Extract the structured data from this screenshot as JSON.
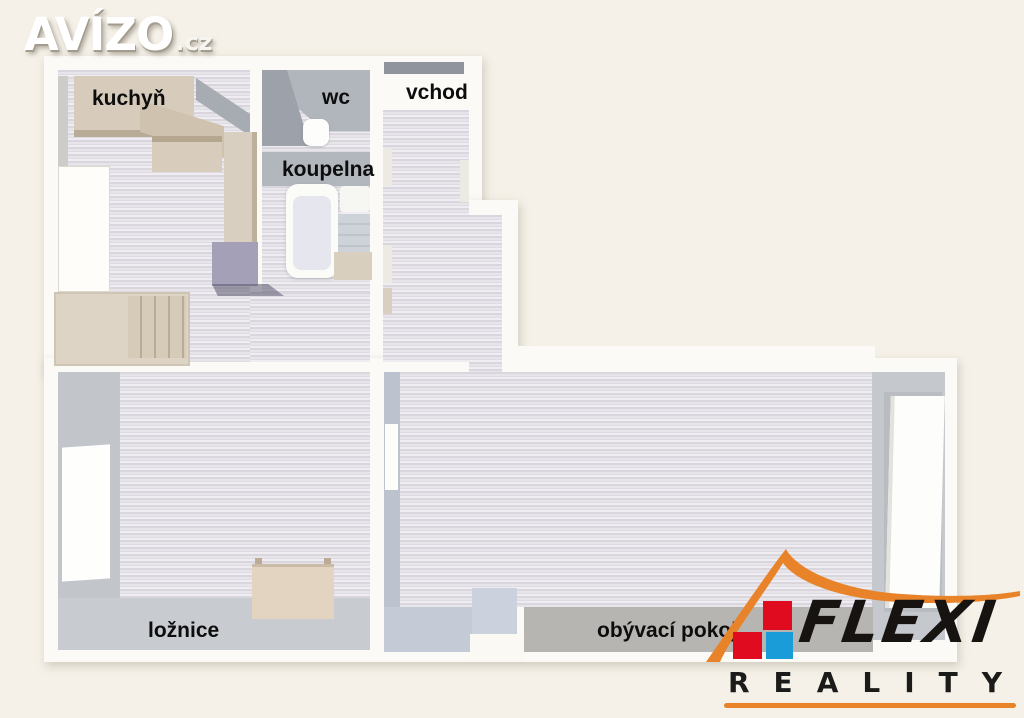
{
  "watermark": {
    "brand": "AVÍZO",
    "tld": ".cz"
  },
  "floorplan": {
    "rooms": [
      {
        "id": "kuchyn",
        "label": "kuchyň"
      },
      {
        "id": "wc",
        "label": "wc"
      },
      {
        "id": "vchod",
        "label": "vchod"
      },
      {
        "id": "koupelna",
        "label": "koupelna"
      },
      {
        "id": "loznice",
        "label": "ložnice"
      },
      {
        "id": "obyvaci-pokoj",
        "label": "obývací pokoj"
      }
    ]
  },
  "agency_logo": {
    "name": "FLEXI",
    "subtitle": "REALITY",
    "icons": [
      "roof-icon",
      "red-square-icon",
      "red-square-icon",
      "blue-square-icon"
    ],
    "colors": {
      "roof_orange": "#e8832a",
      "square_red": "#e00b1e",
      "square_blue": "#199cd8",
      "text_black": "#161310"
    }
  },
  "palette": {
    "background": "#f5f1e8",
    "wall_white": "#fbfaf6",
    "floor_stripe_light": "#e7e5ea",
    "floor_stripe_dark": "#d9d7dd",
    "wall_gray": "#c2c6cb",
    "wall_gray_dark": "#9da1aa",
    "bottom_band_gray": "#b6b5b2",
    "furniture_beige": "#d7ccbb",
    "furniture_purple": "#a4a0b8",
    "label_black": "#0d0d0d",
    "watermark_white": "#ffffff"
  }
}
